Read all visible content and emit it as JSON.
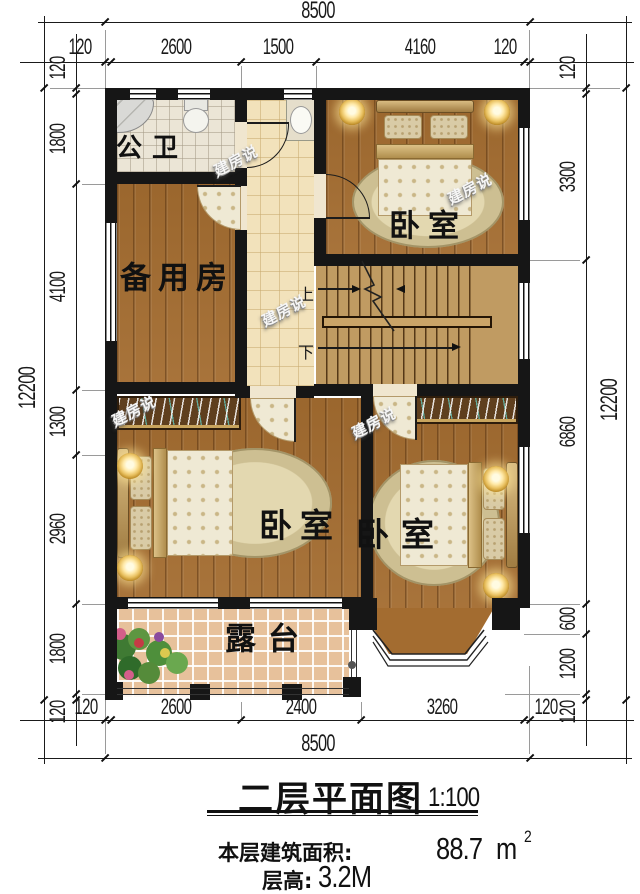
{
  "title": {
    "main": "二层平面图",
    "scale": "1:100",
    "area_label": "本层建筑面积:",
    "area_value": "88.7",
    "area_unit": "m",
    "area_exp": "2",
    "floor_height_label": "层高:",
    "floor_height_value": "3.2M"
  },
  "rooms": {
    "bathroom": "公卫",
    "spare_room": "备用房",
    "bedroom": "卧室",
    "terrace": "露台"
  },
  "stairs": {
    "up": "上",
    "down": "下"
  },
  "watermark": "建房说",
  "dims": {
    "top_total": "8500",
    "top_segments": [
      "120",
      "2600",
      "1500",
      "4160",
      "120"
    ],
    "bottom_segments": [
      "120",
      "2600",
      "2400",
      "3260",
      "120"
    ],
    "bottom_total": "8500",
    "left_total": "12200",
    "left_segments": [
      "120",
      "1800",
      "4100",
      "1300",
      "2960",
      "1800",
      "120"
    ],
    "right_segments": [
      "120",
      "3300",
      "6860",
      "600",
      "1200",
      "120"
    ],
    "right_total": "12200"
  },
  "colors": {
    "wall": "#161616",
    "wood_floor": "#a36c30",
    "stair_floor": "#c09b62",
    "hall_tile": "#f2e2bb",
    "bath_tile": "#ebe5d6",
    "terrace_tile": "#e7c19b",
    "dim_text": "#1a1a1a",
    "lamp_gold": "#e9c161"
  }
}
